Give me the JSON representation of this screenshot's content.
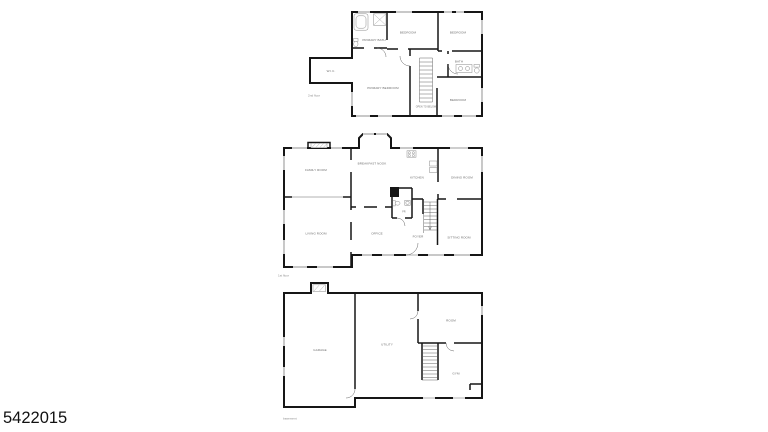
{
  "photo_id": "5422015",
  "colors": {
    "background": "#ffffff",
    "wall": "#161616",
    "room_label": "#6b6b6b",
    "caption": "#8a8a8a",
    "photo_id_text": "#111111"
  },
  "floors": [
    {
      "caption": "2nd floor",
      "rooms": [
        {
          "label": "PRIMARY BATH"
        },
        {
          "label": "BEDROOM"
        },
        {
          "label": "BEDROOM"
        },
        {
          "label": "BATH"
        },
        {
          "label": "BEDROOM"
        },
        {
          "label": "PRIMARY BEDROOM"
        },
        {
          "label": "W.I.C."
        },
        {
          "label": "OPEN TO BELOW"
        }
      ]
    },
    {
      "caption": "1st floor",
      "rooms": [
        {
          "label": "FAMILY ROOM"
        },
        {
          "label": "BREAKFAST NOOK"
        },
        {
          "label": "KITCHEN"
        },
        {
          "label": "DINING ROOM"
        },
        {
          "label": "LIVING ROOM"
        },
        {
          "label": "OFFICE"
        },
        {
          "label": "PR"
        },
        {
          "label": "FOYER"
        },
        {
          "label": "SITTING ROOM"
        }
      ]
    },
    {
      "caption": "basement",
      "rooms": [
        {
          "label": "GARAGE"
        },
        {
          "label": "UTILITY"
        },
        {
          "label": "ROOM"
        },
        {
          "label": "GYM"
        }
      ]
    }
  ]
}
